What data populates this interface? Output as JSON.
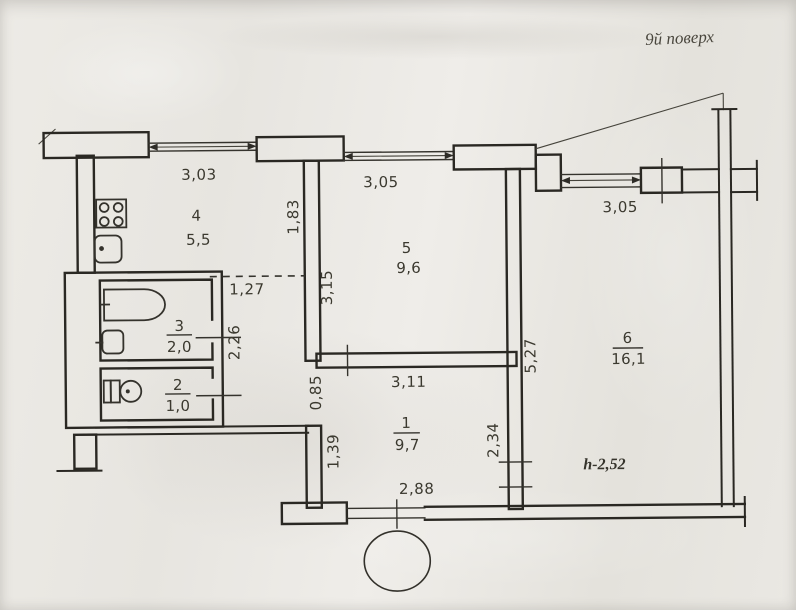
{
  "document": {
    "type_label": "apartment floor plan (scanned)",
    "floor_label": "9й поверх",
    "ceiling_height": "h-2,52"
  },
  "colors": {
    "ink": "#2a2823",
    "paper": "#e9e7e2"
  },
  "rooms": [
    {
      "number": "1",
      "area": "9,7"
    },
    {
      "number": "2",
      "area": "1,0"
    },
    {
      "number": "3",
      "area": "2,0"
    },
    {
      "number": "4",
      "area": "5,5"
    },
    {
      "number": "5",
      "area": "9,6"
    },
    {
      "number": "6",
      "area": "16,1"
    }
  ],
  "dimensions": {
    "kitchen_window": "3,03",
    "room5_window": "3,05",
    "room6_window": "3,05",
    "kitchen_right_wall": "1,83",
    "room5_left_wall": "3,15",
    "kitchen_passage": "1,27",
    "bath_right_wall": "2,26",
    "nook_opening": "0,85",
    "room1_top": "3,11",
    "room6_left_wall": "5,27",
    "room1_left_wall": "1,39",
    "room1_right_wall": "2,34",
    "entry_width": "2,88"
  },
  "fixtures": {
    "stove": "stove-icon",
    "kitchen_sink": "sink-icon",
    "bathtub": "bathtub-icon",
    "washbasin": "washbasin-icon",
    "toilet": "toilet-icon",
    "stamp": "stamp-circle"
  }
}
